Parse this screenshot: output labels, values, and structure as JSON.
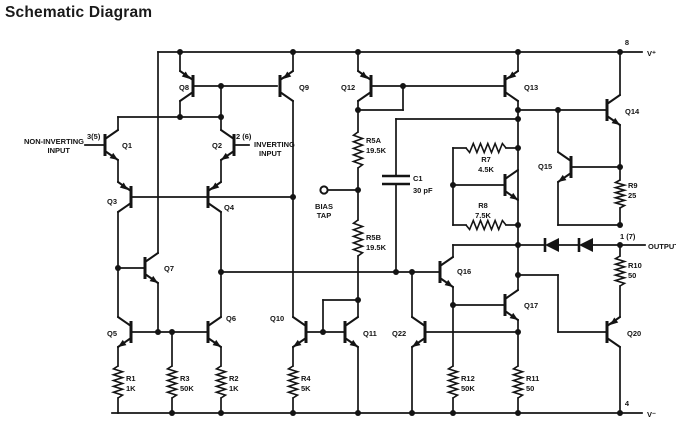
{
  "title": "Schematic Diagram",
  "pins": {
    "noninv_line1": "NON-INVERTING",
    "noninv_line2": "INPUT",
    "noninv_num": "3(5)",
    "inv_num": "2 (6)",
    "inv_line1": "INVERTING",
    "inv_line2": "INPUT",
    "vplus_num": "8",
    "vplus_label": "V⁺",
    "vminus_num": "4",
    "vminus_label": "V⁻",
    "output_num": "1 (7)",
    "output_label": "OUTPUT",
    "bias_line1": "BIAS",
    "bias_line2": "TAP"
  },
  "transistors": {
    "q1": "Q1",
    "q2": "Q2",
    "q3": "Q3",
    "q4": "Q4",
    "q5": "Q5",
    "q6": "Q6",
    "q7": "Q7",
    "q8": "Q8",
    "q9": "Q9",
    "q10": "Q10",
    "q11": "Q11",
    "q12": "Q12",
    "q13": "Q13",
    "q14": "Q14",
    "q15": "Q15",
    "q16": "Q16",
    "q17": "Q17",
    "q20": "Q20",
    "q22": "Q22"
  },
  "resistors": {
    "r1": {
      "name": "R1",
      "value": "1K"
    },
    "r2": {
      "name": "R2",
      "value": "1K"
    },
    "r3": {
      "name": "R3",
      "value": "50K"
    },
    "r4": {
      "name": "R4",
      "value": "5K"
    },
    "r5a": {
      "name": "R5A",
      "value": "19.5K"
    },
    "r5b": {
      "name": "R5B",
      "value": "19.5K"
    },
    "r7": {
      "name": "R7",
      "value": "4.5K"
    },
    "r8": {
      "name": "R8",
      "value": "7.5K"
    },
    "r9": {
      "name": "R9",
      "value": "25"
    },
    "r10": {
      "name": "R10",
      "value": "50"
    },
    "r11": {
      "name": "R11",
      "value": "50"
    },
    "r12": {
      "name": "R12",
      "value": "50K"
    }
  },
  "capacitors": {
    "c1": {
      "name": "C1",
      "value": "30 pF"
    }
  }
}
